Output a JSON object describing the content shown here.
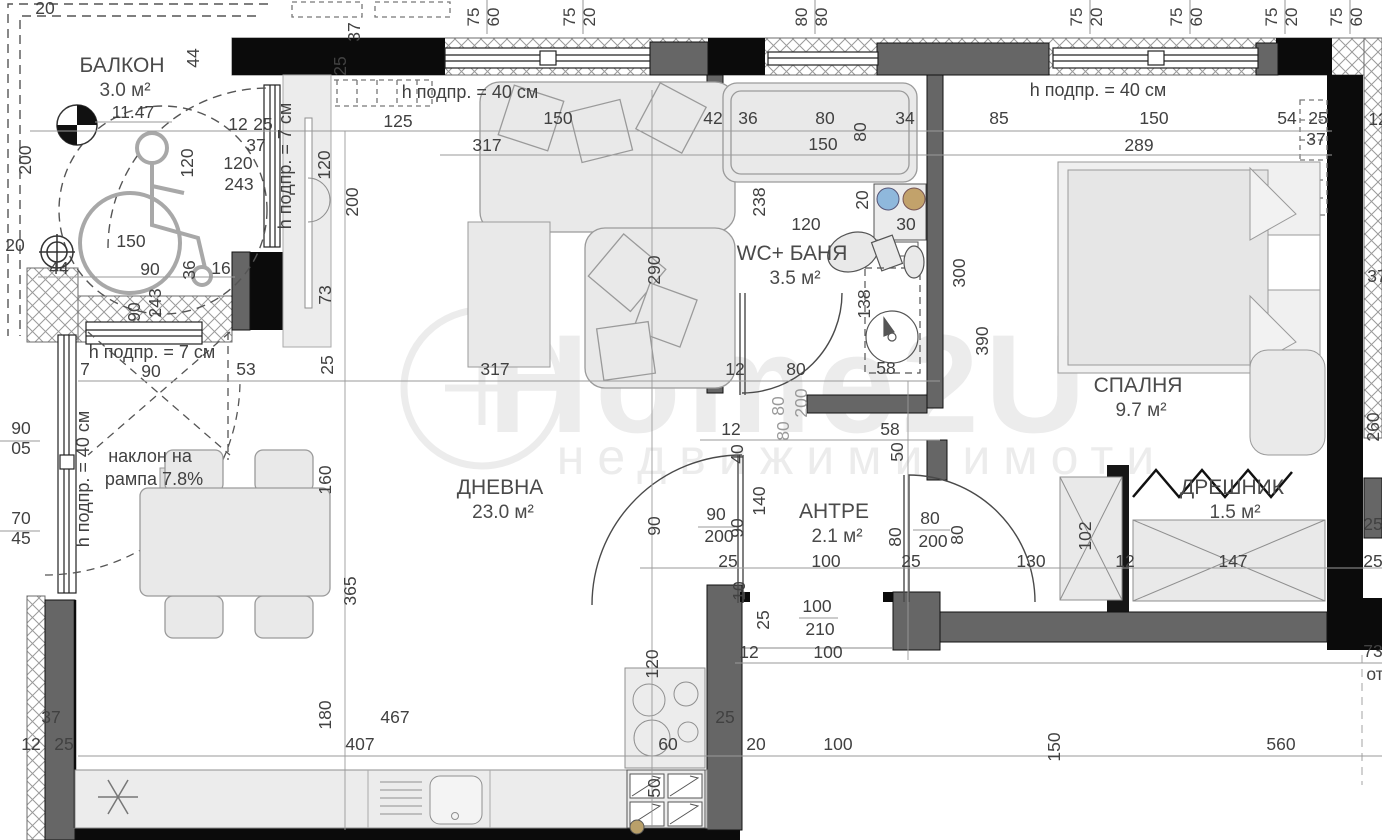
{
  "watermark": {
    "brand": "Home2U",
    "tagline": "недвижими имоти"
  },
  "rooms": [
    {
      "label": "БАЛКОН",
      "area": "3.0 м²",
      "x": 122,
      "y": 72
    },
    {
      "label": "ДНЕВНА",
      "area": "23.0 м²",
      "x": 500,
      "y": 494
    },
    {
      "label": "WC+ БАНЯ",
      "area": "3.5 м²",
      "x": 792,
      "y": 260
    },
    {
      "label": "СПАЛНЯ",
      "area": "9.7 м²",
      "x": 1138,
      "y": 392
    },
    {
      "label": "АНТРЕ",
      "area": "2.1 м²",
      "x": 834,
      "y": 518
    },
    {
      "label": "ДРЕШНИК",
      "area": "1.5 м²",
      "x": 1232,
      "y": 494
    }
  ],
  "notes": [
    {
      "t": "h подпр. = 40 см",
      "x": 470,
      "y": 98
    },
    {
      "t": "h подпр. = 40 см",
      "x": 1098,
      "y": 96
    },
    {
      "t": "h подпр. = 7 см",
      "x": 152,
      "y": 358
    },
    {
      "t": "h подпр. = 7 см",
      "x": 291,
      "y": 166,
      "r": -90
    },
    {
      "t": "h подпр. = 40 см",
      "x": 89,
      "y": 479,
      "r": -90
    },
    {
      "t": "наклон на",
      "x": 150,
      "y": 462
    },
    {
      "t": "рампа 7.8%",
      "x": 154,
      "y": 485
    }
  ],
  "window_tags": [
    {
      "x": 487,
      "a": "75",
      "b": "60"
    },
    {
      "x": 583,
      "a": "75",
      "b": "20"
    },
    {
      "x": 815,
      "a": "80",
      "b": "80"
    },
    {
      "x": 1090,
      "a": "75",
      "b": "20"
    },
    {
      "x": 1190,
      "a": "75",
      "b": "60"
    },
    {
      "x": 1285,
      "a": "75",
      "b": "20"
    },
    {
      "x": 1350,
      "a": "75",
      "b": "60"
    }
  ],
  "dims": [
    {
      "t": "20",
      "x": 45,
      "y": 14
    },
    {
      "t": "25",
      "x": 346,
      "y": 66,
      "r": -90
    },
    {
      "t": "37",
      "x": 360,
      "y": 32,
      "r": -90
    },
    {
      "t": "12",
      "x": 238,
      "y": 130
    },
    {
      "t": "25",
      "x": 263,
      "y": 130
    },
    {
      "t": "125",
      "x": 398,
      "y": 127
    },
    {
      "t": "150",
      "x": 558,
      "y": 124
    },
    {
      "t": "42",
      "x": 713,
      "y": 124
    },
    {
      "t": "36",
      "x": 748,
      "y": 124
    },
    {
      "t": "80",
      "x": 825,
      "y": 124
    },
    {
      "t": "80",
      "x": 866,
      "y": 132,
      "r": -90
    },
    {
      "t": "34",
      "x": 905,
      "y": 124
    },
    {
      "t": "85",
      "x": 999,
      "y": 124
    },
    {
      "t": "150",
      "x": 1154,
      "y": 124
    },
    {
      "t": "54",
      "x": 1287,
      "y": 124
    },
    {
      "t": "25",
      "x": 1318,
      "y": 124
    },
    {
      "t": "12",
      "x": 1378,
      "y": 125
    },
    {
      "t": "317",
      "x": 487,
      "y": 151
    },
    {
      "t": "150",
      "x": 823,
      "y": 150
    },
    {
      "t": "289",
      "x": 1139,
      "y": 151
    },
    {
      "t": "37",
      "x": 1316,
      "y": 145
    },
    {
      "t": "44",
      "x": 199,
      "y": 58,
      "r": -90
    },
    {
      "t": "200",
      "x": 31,
      "y": 160,
      "r": -90
    },
    {
      "t": "120",
      "x": 193,
      "y": 163,
      "r": -90
    },
    {
      "t": "37",
      "x": 256,
      "y": 151
    },
    {
      "t": "120",
      "x": 238,
      "y": 169
    },
    {
      "t": "243",
      "x": 239,
      "y": 190
    },
    {
      "t": "120",
      "x": 330,
      "y": 165,
      "r": -90
    },
    {
      "t": "200",
      "x": 358,
      "y": 202,
      "r": -90
    },
    {
      "t": "73",
      "x": 331,
      "y": 295,
      "r": -90
    },
    {
      "t": "25",
      "x": 333,
      "y": 365,
      "r": -90
    },
    {
      "t": "11.47",
      "x": 133,
      "y": 118
    },
    {
      "t": "20",
      "x": 15,
      "y": 251
    },
    {
      "t": "44",
      "x": 59,
      "y": 274
    },
    {
      "t": "150",
      "x": 131,
      "y": 247
    },
    {
      "t": "90",
      "x": 150,
      "y": 275
    },
    {
      "t": "36",
      "x": 195,
      "y": 270,
      "r": -90
    },
    {
      "t": "16",
      "x": 221,
      "y": 274
    },
    {
      "t": "90",
      "x": 140,
      "y": 312,
      "r": -90
    },
    {
      "t": "243",
      "x": 161,
      "y": 303,
      "r": -90
    },
    {
      "t": "7",
      "x": 85,
      "y": 375
    },
    {
      "t": "90",
      "x": 151,
      "y": 377
    },
    {
      "t": "53",
      "x": 246,
      "y": 375
    },
    {
      "t": "90",
      "x": 21,
      "y": 434
    },
    {
      "t": "05",
      "x": 21,
      "y": 454
    },
    {
      "t": "70",
      "x": 21,
      "y": 524
    },
    {
      "t": "45",
      "x": 21,
      "y": 544
    },
    {
      "t": "160",
      "x": 331,
      "y": 480,
      "r": -90
    },
    {
      "t": "365",
      "x": 356,
      "y": 591,
      "r": -90
    },
    {
      "t": "37",
      "x": 51,
      "y": 723
    },
    {
      "t": "12",
      "x": 31,
      "y": 750
    },
    {
      "t": "25",
      "x": 64,
      "y": 750
    },
    {
      "t": "180",
      "x": 331,
      "y": 715,
      "r": -90
    },
    {
      "t": "467",
      "x": 395,
      "y": 723
    },
    {
      "t": "407",
      "x": 360,
      "y": 750
    },
    {
      "t": "120",
      "x": 658,
      "y": 664,
      "r": -90
    },
    {
      "t": "60",
      "x": 668,
      "y": 750
    },
    {
      "t": "50",
      "x": 660,
      "y": 788,
      "r": -90
    },
    {
      "t": "25",
      "x": 725,
      "y": 723
    },
    {
      "t": "20",
      "x": 756,
      "y": 750
    },
    {
      "t": "100",
      "x": 838,
      "y": 750
    },
    {
      "t": "150",
      "x": 1060,
      "y": 747,
      "r": -90
    },
    {
      "t": "560",
      "x": 1281,
      "y": 750
    },
    {
      "t": "12",
      "x": 749,
      "y": 658
    },
    {
      "t": "100",
      "x": 828,
      "y": 658
    },
    {
      "t": "100",
      "x": 817,
      "y": 612
    },
    {
      "t": "210",
      "x": 820,
      "y": 635
    },
    {
      "t": "25",
      "x": 728,
      "y": 567
    },
    {
      "t": "100",
      "x": 826,
      "y": 567
    },
    {
      "t": "25",
      "x": 911,
      "y": 567
    },
    {
      "t": "130",
      "x": 1031,
      "y": 567
    },
    {
      "t": "10",
      "x": 745,
      "y": 591,
      "r": -90
    },
    {
      "t": "25",
      "x": 769,
      "y": 620,
      "r": -90
    },
    {
      "t": "290",
      "x": 660,
      "y": 270,
      "r": -90
    },
    {
      "t": "317",
      "x": 495,
      "y": 375
    },
    {
      "t": "12",
      "x": 735,
      "y": 375
    },
    {
      "t": "80",
      "x": 796,
      "y": 375
    },
    {
      "t": "58",
      "x": 886,
      "y": 374
    },
    {
      "t": "80",
      "x": 784,
      "y": 406,
      "r": -90,
      "c": "#9a9a9a"
    },
    {
      "t": "200",
      "x": 807,
      "y": 403,
      "r": -90,
      "c": "#9a9a9a"
    },
    {
      "t": "80",
      "x": 789,
      "y": 431,
      "r": -90,
      "c": "#9a9a9a"
    },
    {
      "t": "12",
      "x": 731,
      "y": 435
    },
    {
      "t": "58",
      "x": 890,
      "y": 435
    },
    {
      "t": "50",
      "x": 903,
      "y": 452,
      "r": -90
    },
    {
      "t": "40",
      "x": 743,
      "y": 454,
      "r": -90
    },
    {
      "t": "90",
      "x": 660,
      "y": 526,
      "r": -90
    },
    {
      "t": "90",
      "x": 716,
      "y": 520
    },
    {
      "t": "200",
      "x": 719,
      "y": 542
    },
    {
      "t": "90",
      "x": 743,
      "y": 528,
      "r": -90
    },
    {
      "t": "140",
      "x": 765,
      "y": 501,
      "r": -90
    },
    {
      "t": "80",
      "x": 901,
      "y": 537,
      "r": -90
    },
    {
      "t": "80",
      "x": 930,
      "y": 524
    },
    {
      "t": "200",
      "x": 933,
      "y": 547
    },
    {
      "t": "80",
      "x": 963,
      "y": 535,
      "r": -90
    },
    {
      "t": "238",
      "x": 765,
      "y": 202,
      "r": -90
    },
    {
      "t": "120",
      "x": 806,
      "y": 230
    },
    {
      "t": "20",
      "x": 868,
      "y": 200,
      "r": -90
    },
    {
      "t": "30",
      "x": 906,
      "y": 230
    },
    {
      "t": "138",
      "x": 870,
      "y": 304,
      "r": -90
    },
    {
      "t": "300",
      "x": 965,
      "y": 273,
      "r": -90
    },
    {
      "t": "390",
      "x": 988,
      "y": 341,
      "r": -90
    },
    {
      "t": "102",
      "x": 1091,
      "y": 536,
      "r": -90
    },
    {
      "t": "12",
      "x": 1125,
      "y": 567
    },
    {
      "t": "147",
      "x": 1233,
      "y": 567
    },
    {
      "t": "25",
      "x": 1373,
      "y": 567
    },
    {
      "t": "37",
      "x": 1377,
      "y": 282
    },
    {
      "t": "260",
      "x": 1379,
      "y": 427,
      "r": -90
    },
    {
      "t": "25",
      "x": 1373,
      "y": 530
    },
    {
      "t": "73",
      "x": 1373,
      "y": 657
    },
    {
      "t": "от",
      "x": 1375,
      "y": 680
    }
  ]
}
